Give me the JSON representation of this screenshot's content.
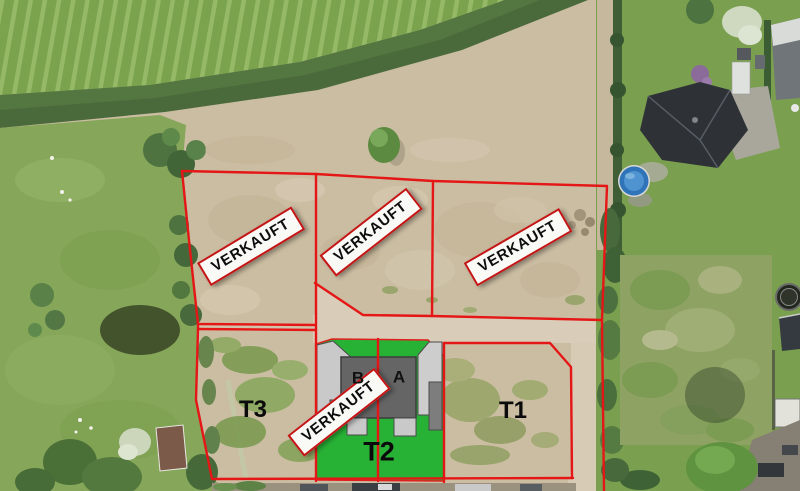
{
  "labels": {
    "sold": "VERKAUFT",
    "plot_t1": "T1",
    "plot_t2": "T2",
    "plot_t3": "T3",
    "unit_a": "A",
    "unit_b": "B"
  },
  "colors": {
    "boundary_red": "#e51616",
    "sold_banner_bg": "#f9f9f6",
    "sold_banner_border": "#c41414",
    "plot_lawn_green": "#28b235",
    "house_gray": "#656565",
    "garage_light_gray": "#c9c9c9",
    "pool_blue": "#2f74b8",
    "field_green": "#7ba24c",
    "dirt_tan": "#cbbda2"
  }
}
